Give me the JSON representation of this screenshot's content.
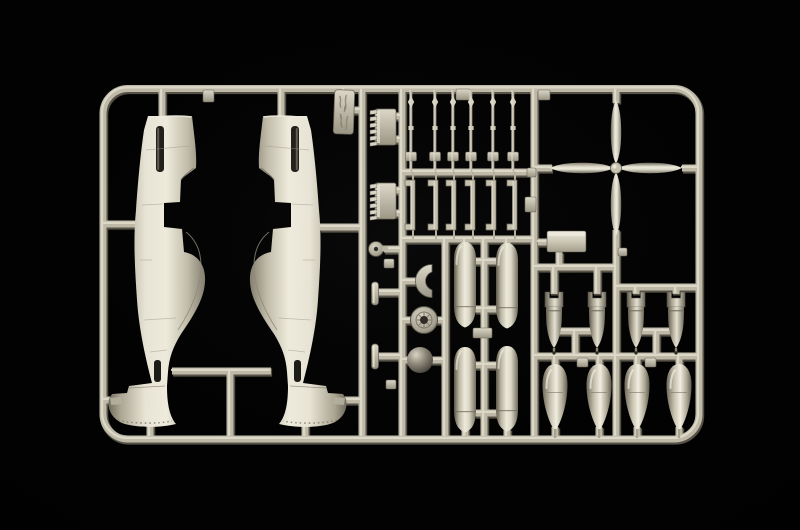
{
  "scene": {
    "title": "Photograph of a plastic model kit sprue on a black background",
    "subject": "Injection-molded sprue of light ivory styrene with WWII fighter (P-51 style) parts",
    "background_color": "#020202",
    "plastic_base_color": "#c0bba9",
    "plastic_highlight_color": "#e9e5d6",
    "plastic_shadow_color": "#5f5b50"
  },
  "parts": [
    {
      "name": "fuselage-half-left",
      "label": "Aircraft fuselage half (left, nose up, tail fin flared left)",
      "count": 1
    },
    {
      "name": "fuselage-half-right",
      "label": "Aircraft fuselage half (right, mirrored)",
      "count": 1
    },
    {
      "name": "sprue-tag",
      "label": "Molded sprue ID tag (embossed, illegible)",
      "count": 1
    },
    {
      "name": "exhaust-stack",
      "label": "Engine exhaust stack strip",
      "count": 2
    },
    {
      "name": "strut",
      "label": "Thin strut / barrel rod",
      "count": 6
    },
    {
      "name": "bracket",
      "label": "C-shaped bracket part",
      "count": 6
    },
    {
      "name": "fuel-tank-half",
      "label": "Cylindrical drop-tank half (large)",
      "count": 4
    },
    {
      "name": "bomb",
      "label": "Finned bomb",
      "count": 4
    },
    {
      "name": "teardrop-tank-half",
      "label": "Teardrop drop-tank half",
      "count": 4
    },
    {
      "name": "propeller",
      "label": "Four-blade propeller",
      "count": 1
    },
    {
      "name": "wheel",
      "label": "Spoked main wheel",
      "count": 1
    },
    {
      "name": "spinner",
      "label": "Dark dome / spinner ball",
      "count": 1
    },
    {
      "name": "tail-wheel",
      "label": "Tail wheel",
      "count": 1
    },
    {
      "name": "scoop",
      "label": "Radiator scoop panel",
      "count": 1
    },
    {
      "name": "crescent",
      "label": "Half-moon former",
      "count": 1
    },
    {
      "name": "small-bar",
      "label": "Small bar / mast part",
      "count": 2
    },
    {
      "name": "sprue-frame",
      "label": "Rounded rectangular sprue frame with runners",
      "count": 1
    }
  ]
}
